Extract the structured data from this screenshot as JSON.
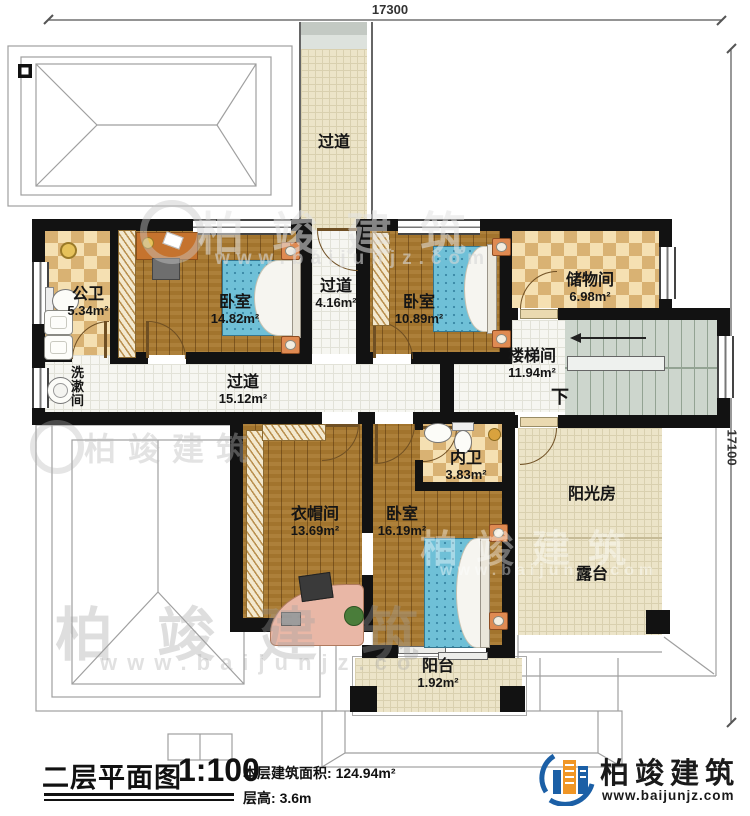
{
  "dimensions": {
    "top": "17300",
    "right": "17100"
  },
  "rooms": {
    "corridor_top": {
      "name": "过道"
    },
    "public_bath": {
      "name": "公卫",
      "area": "5.34m²"
    },
    "bedroom1": {
      "name": "卧室",
      "area": "14.82m²"
    },
    "corridor_small": {
      "name": "过道",
      "area": "4.16m²"
    },
    "bedroom2": {
      "name": "卧室",
      "area": "10.89m²"
    },
    "storage": {
      "name": "储物间",
      "area": "6.98m²"
    },
    "stairwell": {
      "name": "楼梯间",
      "area": "11.94m²",
      "down": "下"
    },
    "washroom": {
      "name": "洗漱间"
    },
    "corridor_main": {
      "name": "过道",
      "area": "15.12m²"
    },
    "cloakroom": {
      "name": "衣帽间",
      "area": "13.69m²"
    },
    "bedroom3": {
      "name": "卧室",
      "area": "16.19m²"
    },
    "private_bath": {
      "name": "内卫",
      "area": "3.83m²"
    },
    "sunroom": {
      "name": "阳光房"
    },
    "terrace": {
      "name": "露台"
    },
    "balcony": {
      "name": "阳台",
      "area": "1.92m²"
    }
  },
  "title_block": {
    "title": "二层平面图",
    "scale": "1:100",
    "area_label": "本层建筑面积:",
    "area_value": "124.94m²",
    "height_label": "层高:",
    "height_value": "3.6m"
  },
  "brand": {
    "name": "柏竣建筑",
    "url": "www.baijunjz.com"
  },
  "watermark": {
    "name": "柏竣建筑",
    "url": "www.baijunjz.com"
  },
  "colors": {
    "wall": "#111111",
    "wood": "#a9792f",
    "check_light": "#f5e0b2",
    "check_dark": "#d9b273",
    "bed_blue": "#6fc0d7",
    "brand_blue": "#1b5fa6",
    "brand_orange": "#f09626"
  }
}
